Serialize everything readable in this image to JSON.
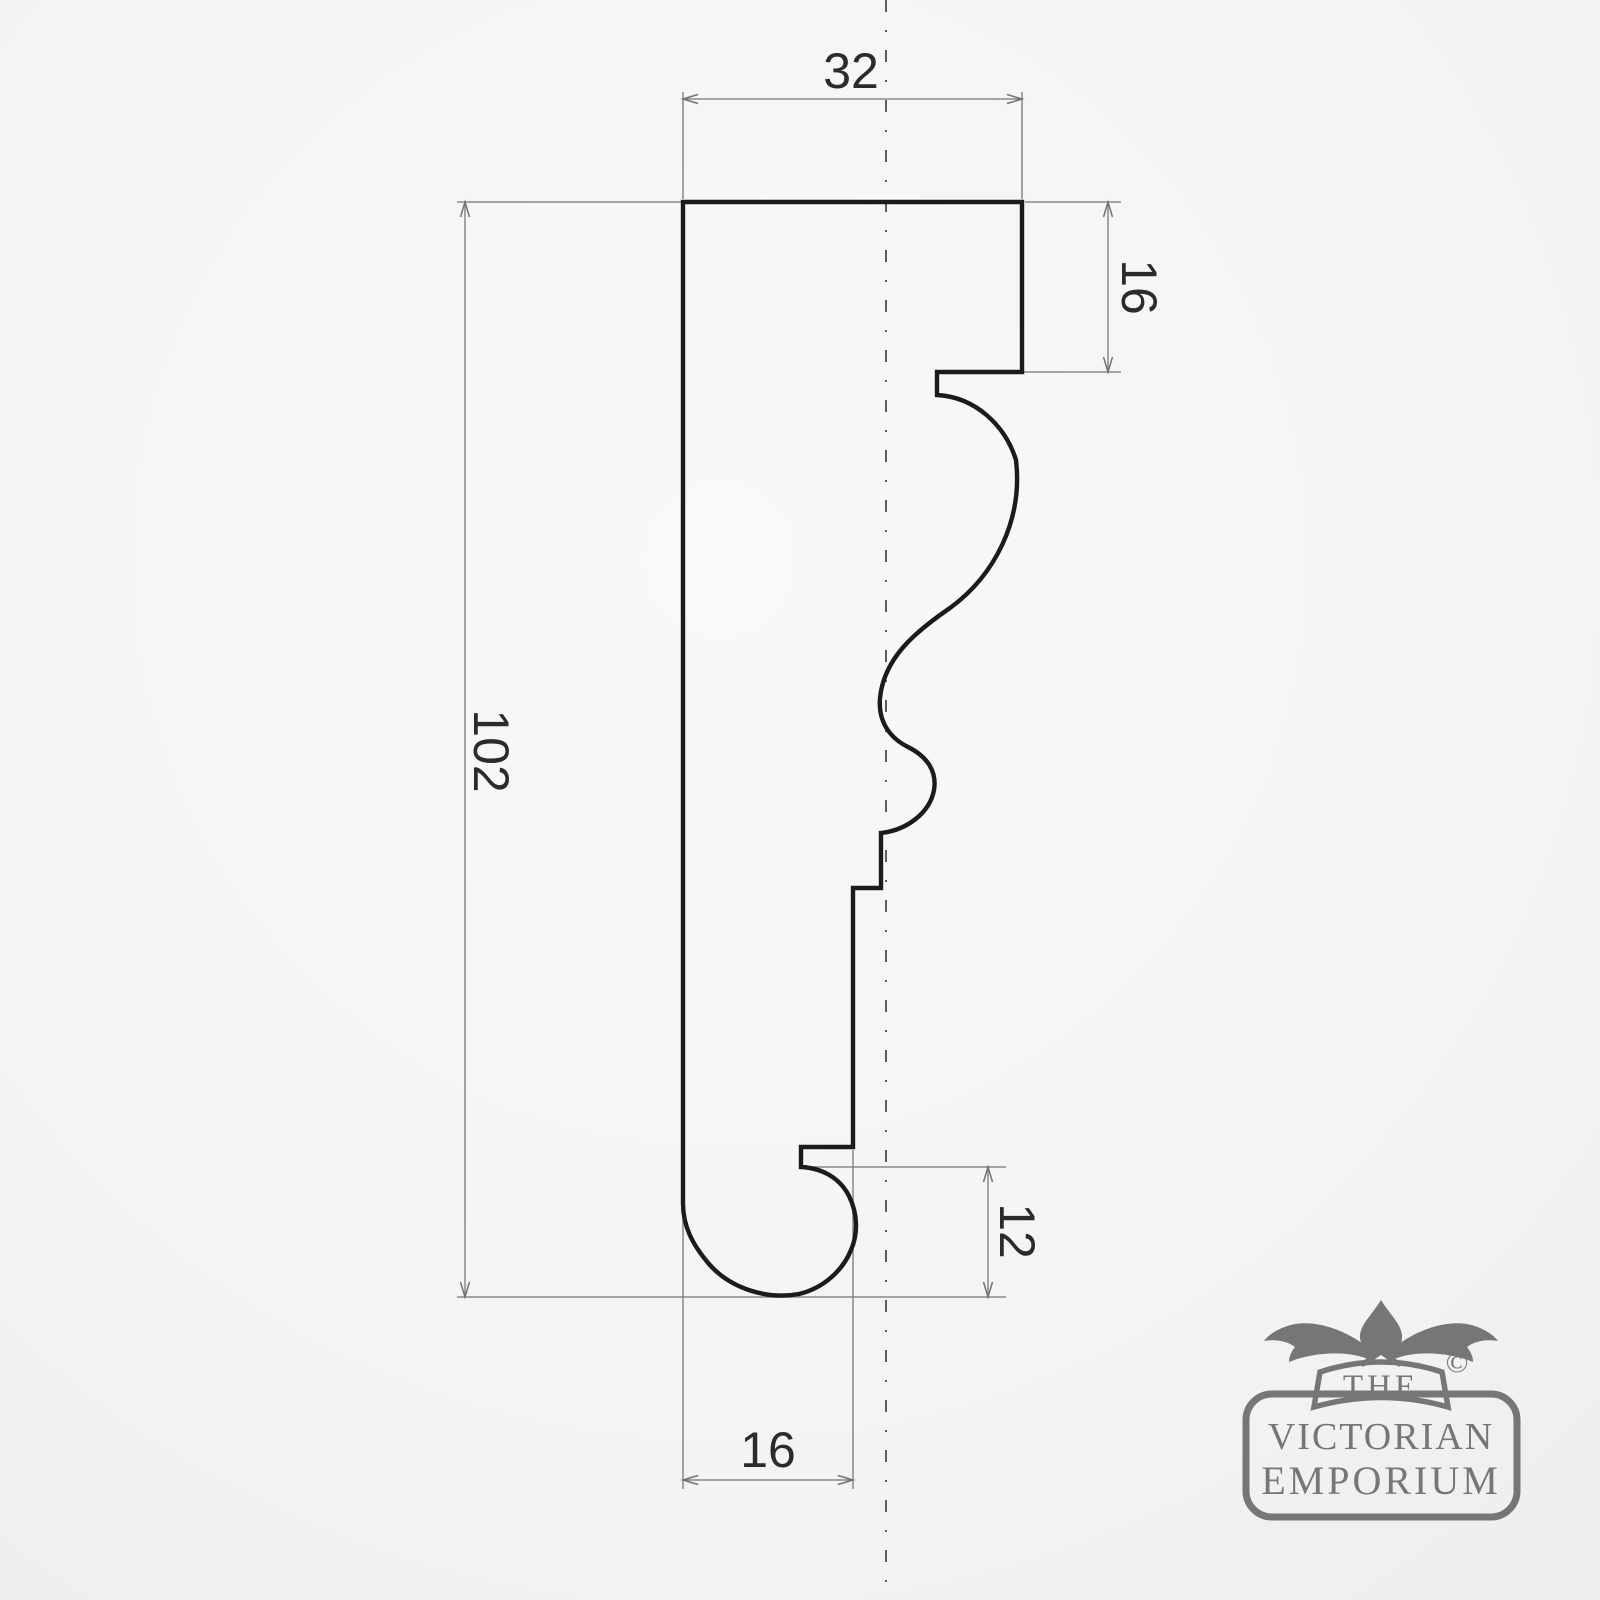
{
  "drawing": {
    "type": "moulding-profile-cross-section",
    "dims": {
      "top_width": "32",
      "right_depth": "16",
      "overall_height": "102",
      "bottom_right_depth": "12",
      "bottom_width": "16"
    },
    "colors": {
      "outline": "#1b1b1b",
      "dimension_lines": "#85888c",
      "dimension_text": "#2b2b2b",
      "centerline": "#4d4d4d"
    }
  },
  "logo": {
    "the": "THE",
    "line1": "VICTORIAN",
    "line2": "EMPORIUM",
    "copyright": "©",
    "color": "#767676"
  }
}
